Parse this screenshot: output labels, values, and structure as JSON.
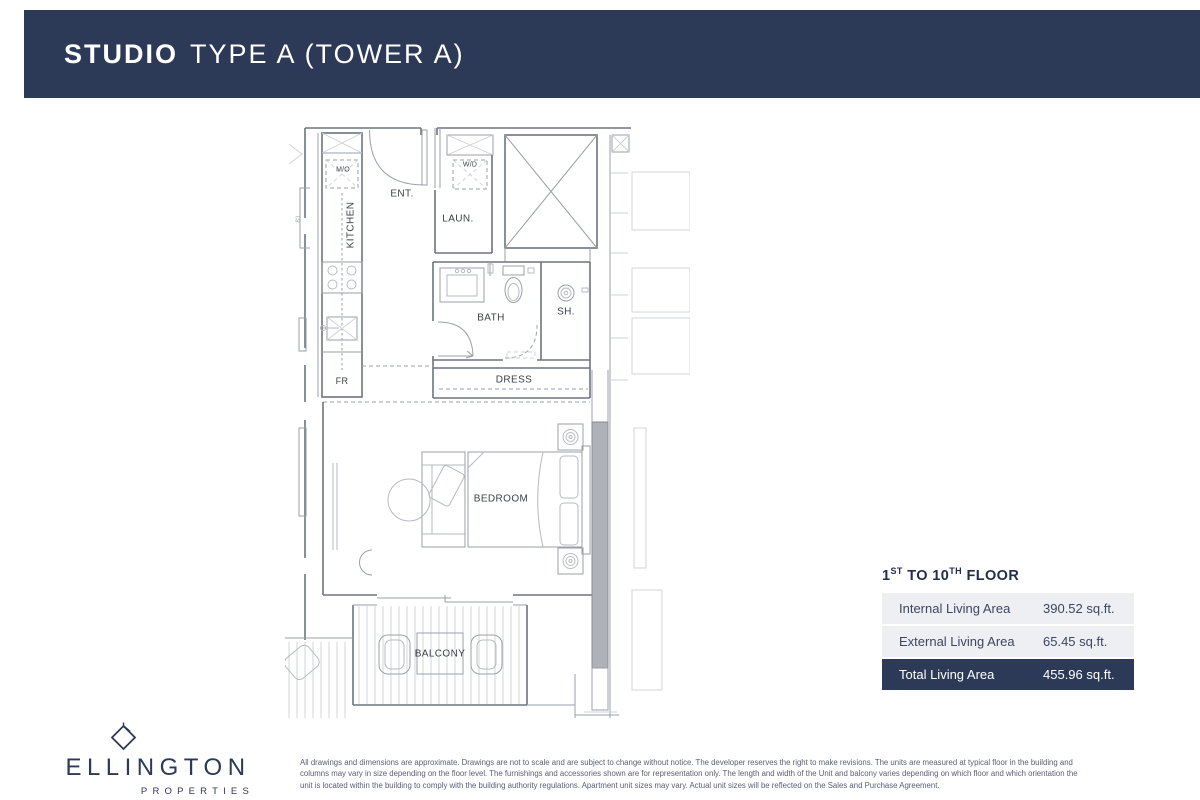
{
  "header": {
    "title_bold": "STUDIO",
    "title_rest": "TYPE A (TOWER A)"
  },
  "plan": {
    "labels": {
      "mo": "M/O",
      "kitchen": "KITCHEN",
      "ent": "ENT.",
      "wd": "W/D",
      "laun": "LAUN.",
      "bath": "BATH",
      "sh": "SH.",
      "dress": "DRESS",
      "fr": "FR",
      "bedroom": "BEDROOM",
      "balcony": "BALCONY",
      "dim": "8'L"
    }
  },
  "area_table": {
    "floor_heading": {
      "n1": "1",
      "s1": "ST",
      "mid": " TO 10",
      "s2": "TH",
      "end": " FLOOR"
    },
    "rows": [
      {
        "label": "Internal Living Area",
        "value": "390.52 sq.ft."
      },
      {
        "label": "External Living Area",
        "value": "65.45 sq.ft."
      },
      {
        "label": "Total Living Area",
        "value": "455.96 sq.ft."
      }
    ]
  },
  "logo": {
    "brand": "ELLINGTON",
    "sub": "PROPERTIES"
  },
  "disclaimer": "All drawings and dimensions are approximate. Drawings are not to scale and are subject to change without notice. The developer reserves the right to make revisions. The units are measured at typical floor in the building and columns may vary in size depending on the floor level. The furnishings and accessories shown are for representation only. The length and width of the Unit and balcony varies depending on which floor and which orientation the unit is located within the building to comply with the building authority regulations. Apartment unit sizes may vary. Actual unit sizes will be reflected on the Sales and Purchase Agreement.",
  "colors": {
    "navy": "#2d3a57",
    "row_bg": "#edeff2"
  }
}
